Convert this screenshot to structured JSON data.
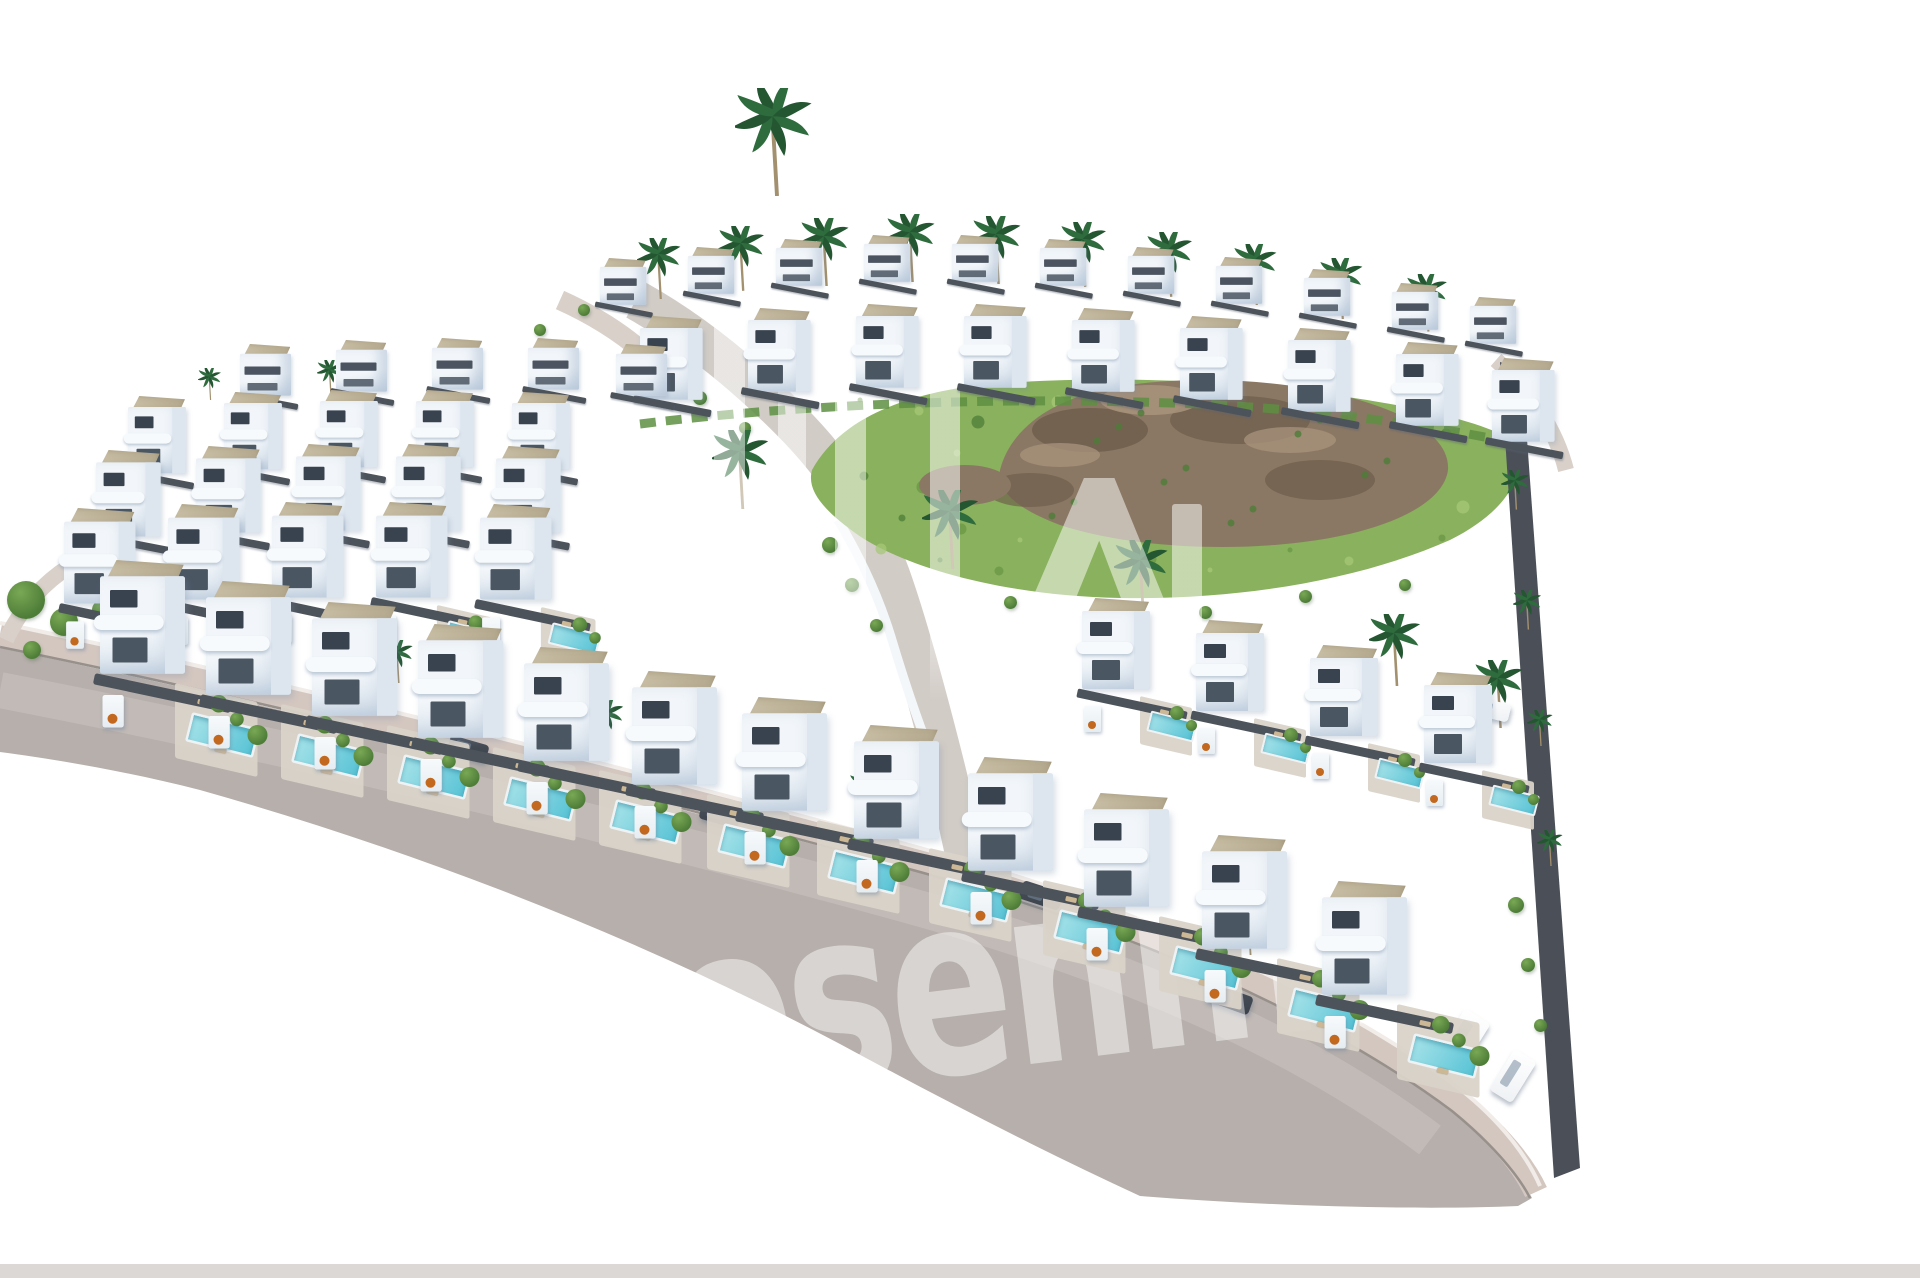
{
  "meta": {
    "kind": "aerial 3D architectural render",
    "subject": "white modern villa development with private pools, palm trees, green hillside and rock garden on white cut-out background"
  },
  "watermark": {
    "text": "rosenmil",
    "color": "#ffffff",
    "opacity": 0.46,
    "rotation_deg": -7,
    "bars": [
      [
        714,
        296,
        31,
        400
      ],
      [
        778,
        362,
        28,
        344
      ],
      [
        835,
        358,
        31,
        340
      ],
      [
        930,
        300,
        30,
        402
      ],
      [
        1172,
        504,
        30,
        198
      ]
    ],
    "chevron": {
      "x": 988,
      "y": 478,
      "w": 218,
      "h": 224
    }
  },
  "palette": {
    "bg": "#ffffff",
    "villa_face": "#f2f6fa",
    "villa_shade": "#cfdbe7",
    "villa_side": "#dde6ef",
    "window": "#39434f",
    "window2": "#4b5663",
    "roof": "#c9bfa6",
    "roof_dark": "#b2a78c",
    "fence": "#4d535b",
    "gate_white": "#f7fafc",
    "planter": "#c2691f",
    "pool_light": "#a5e2e9",
    "pool_deep": "#58c3d5",
    "pool_rim": "#edf2f5",
    "patio": "#d9d3c9",
    "road": "#b6afab",
    "road_light": "#c6bfbb",
    "sidewalk": "#d4c7c0",
    "curb_white": "#f1ece8",
    "curb_dark": "#97908b",
    "int_street": "#d2ccc6",
    "path": "#d8d0c9",
    "hill": "#8ab15d",
    "hill_dark": "#6a9745",
    "hill_light": "#a5c878",
    "rock": "#8b7864",
    "rock_dark": "#6d5c4a",
    "rock_light": "#a6917a",
    "wall": "#4b5058",
    "bottom_strip": "#dcd8d5",
    "tree": "#4e7d38",
    "tree_light": "#79a855",
    "palm": "#2e6b3d",
    "palm_dark": "#235631",
    "trunk": "#a2906f",
    "car_dark": "#3a414a",
    "car_white": "#eef1f4",
    "hedge": "#5e8f42"
  },
  "scene": {
    "rows": [
      {
        "name": "ridge-back-row",
        "type": "back",
        "scale": 0.68,
        "villas": [
          [
            600,
            258
          ],
          [
            688,
            247
          ],
          [
            776,
            239
          ],
          [
            864,
            235
          ],
          [
            952,
            235
          ],
          [
            1040,
            239
          ],
          [
            1128,
            247
          ],
          [
            1216,
            257
          ],
          [
            1304,
            269
          ],
          [
            1392,
            283
          ],
          [
            1470,
            297
          ]
        ]
      },
      {
        "name": "ridge-front-row",
        "type": "mid",
        "scale": 0.92,
        "villas": [
          [
            640,
            316
          ],
          [
            748,
            308
          ],
          [
            856,
            304
          ],
          [
            964,
            304
          ],
          [
            1072,
            308
          ],
          [
            1180,
            316
          ],
          [
            1288,
            328
          ],
          [
            1396,
            342
          ],
          [
            1492,
            358
          ]
        ]
      },
      {
        "name": "upper-left-row",
        "type": "back",
        "scale": 0.75,
        "villas": [
          [
            240,
            344
          ],
          [
            336,
            340
          ],
          [
            432,
            338
          ],
          [
            528,
            338
          ],
          [
            616,
            344
          ]
        ]
      },
      {
        "name": "left-back-row",
        "type": "mid",
        "scale": 0.85,
        "villas": [
          [
            128,
            396
          ],
          [
            224,
            392
          ],
          [
            320,
            390
          ],
          [
            416,
            390
          ],
          [
            512,
            392
          ]
        ]
      },
      {
        "name": "left-mid-row",
        "type": "mid",
        "scale": 0.95,
        "villas": [
          [
            96,
            450
          ],
          [
            196,
            446
          ],
          [
            296,
            444
          ],
          [
            396,
            444
          ],
          [
            496,
            446
          ]
        ]
      },
      {
        "name": "left-front-row",
        "type": "mid2",
        "scale": 1.05,
        "villas": [
          [
            64,
            508
          ],
          [
            168,
            504
          ],
          [
            272,
            502
          ],
          [
            376,
            502
          ],
          [
            480,
            504
          ]
        ]
      },
      {
        "name": "right-mid-row",
        "type": "mid2",
        "scale": 1.0,
        "villas": [
          [
            1082,
            598
          ],
          [
            1196,
            620
          ],
          [
            1310,
            645
          ],
          [
            1424,
            672
          ]
        ]
      },
      {
        "name": "front-row",
        "type": "front",
        "scale": 1.25,
        "villas": [
          [
            100,
            560
          ],
          [
            206,
            581
          ],
          [
            312,
            602
          ],
          [
            418,
            624
          ],
          [
            524,
            647
          ],
          [
            632,
            671
          ],
          [
            742,
            697
          ],
          [
            854,
            725
          ],
          [
            968,
            757
          ],
          [
            1084,
            793
          ],
          [
            1202,
            835
          ],
          [
            1322,
            881
          ]
        ]
      }
    ],
    "palms": [
      [
        775,
        88,
        1.5
      ],
      [
        660,
        238,
        0.85
      ],
      [
        742,
        226,
        0.9
      ],
      [
        826,
        218,
        0.95
      ],
      [
        912,
        214,
        0.95
      ],
      [
        998,
        216,
        0.95
      ],
      [
        1084,
        222,
        0.9
      ],
      [
        1170,
        232,
        0.9
      ],
      [
        1256,
        244,
        0.85
      ],
      [
        1342,
        258,
        0.85
      ],
      [
        1428,
        274,
        0.8
      ],
      [
        330,
        360,
        0.5
      ],
      [
        210,
        368,
        0.45
      ],
      [
        742,
        430,
        1.1
      ],
      [
        952,
        490,
        1.1
      ],
      [
        1142,
        540,
        1.05
      ],
      [
        1396,
        614,
        1.0
      ],
      [
        1500,
        660,
        0.95
      ],
      [
        398,
        640,
        0.6
      ],
      [
        608,
        700,
        0.65
      ],
      [
        868,
        772,
        0.7
      ],
      [
        1108,
        850,
        0.75
      ],
      [
        1250,
        905,
        0.7
      ],
      [
        1516,
        470,
        0.55
      ],
      [
        1528,
        590,
        0.55
      ],
      [
        1540,
        710,
        0.5
      ],
      [
        1550,
        830,
        0.5
      ]
    ],
    "shrubs": [
      [
        26,
        600,
        38
      ],
      [
        64,
        622,
        28
      ],
      [
        102,
        610,
        20
      ],
      [
        32,
        650,
        18
      ],
      [
        152,
        582,
        14
      ],
      [
        584,
        310,
        12
      ],
      [
        540,
        330,
        12
      ],
      [
        660,
        372,
        16
      ],
      [
        700,
        398,
        14
      ],
      [
        745,
        428,
        12
      ],
      [
        830,
        545,
        16
      ],
      [
        852,
        585,
        14
      ],
      [
        876,
        625,
        13
      ],
      [
        1010,
        602,
        13
      ],
      [
        1105,
        615,
        13
      ],
      [
        1205,
        612,
        13
      ],
      [
        1305,
        596,
        13
      ],
      [
        1405,
        585,
        12
      ],
      [
        1516,
        905,
        16
      ],
      [
        1528,
        965,
        14
      ],
      [
        1540,
        1025,
        13
      ]
    ],
    "cars": [
      {
        "x": 448,
        "y": 740,
        "angle": 16,
        "kind": "dark",
        "w": 40,
        "h": 18
      },
      {
        "x": 700,
        "y": 806,
        "angle": 16,
        "kind": "dark",
        "w": 40,
        "h": 18
      },
      {
        "x": 1020,
        "y": 886,
        "angle": 18,
        "kind": "dark",
        "w": 42,
        "h": 19
      },
      {
        "x": 1210,
        "y": 990,
        "angle": 20,
        "kind": "dark",
        "w": 42,
        "h": 19
      },
      {
        "x": 1470,
        "y": 700,
        "angle": 14,
        "kind": "white",
        "w": 40,
        "h": 18
      },
      {
        "x": 1448,
        "y": 1012,
        "angle": 32,
        "kind": "white",
        "w": 30,
        "h": 56
      },
      {
        "x": 1500,
        "y": 1052,
        "angle": 32,
        "kind": "white",
        "w": 26,
        "h": 48
      }
    ]
  }
}
